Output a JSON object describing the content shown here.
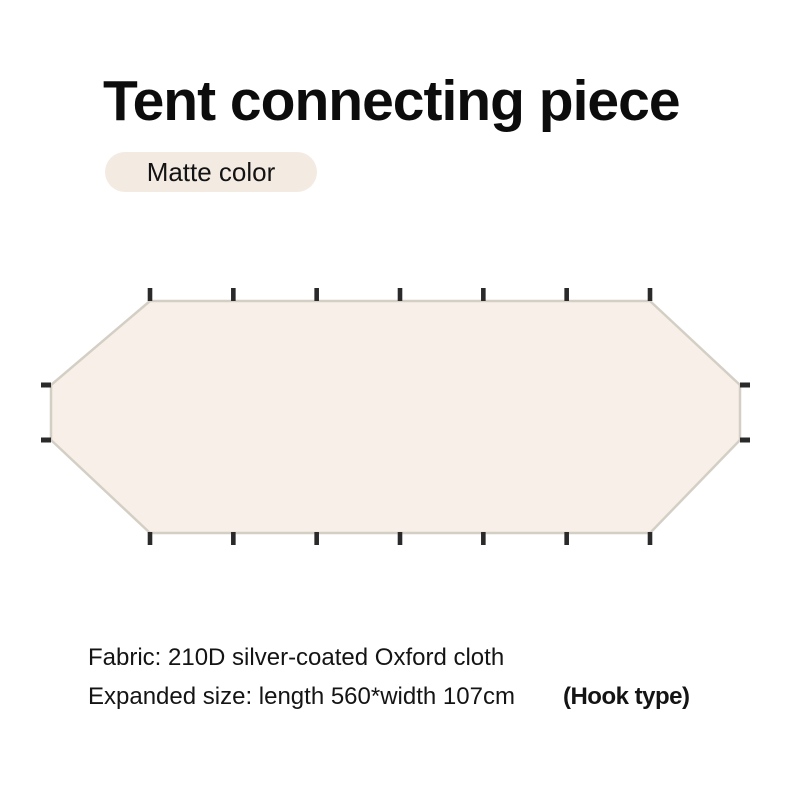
{
  "header": {
    "title": "Tent connecting piece",
    "badge_label": "Matte color",
    "badge_bg_color": "#f3eae2"
  },
  "diagram": {
    "fill_color": "#f7efe8",
    "border_color": "#d4cfc5",
    "hook_color": "#2a2a2a",
    "hooks": {
      "top": 7,
      "bottom": 7,
      "left": 2,
      "right": 2
    }
  },
  "specs": {
    "fabric_line": "Fabric: 210D silver-coated Oxford cloth",
    "size_line": "Expanded size: length 560*width 107cm",
    "hook_type_label": "(Hook type)"
  }
}
